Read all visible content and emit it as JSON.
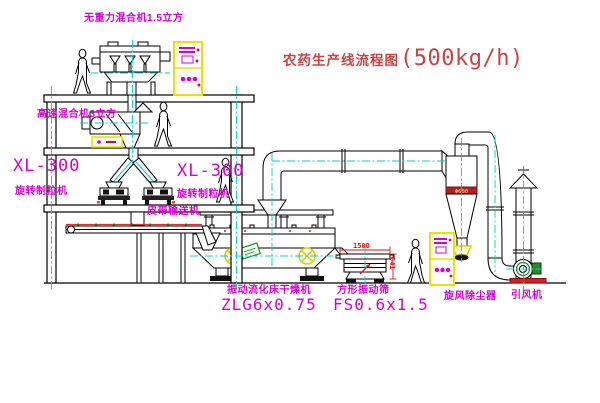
{
  "drawing": {
    "title_zh": "农药生产线流程图",
    "title_capacity": "(500kg/h)"
  },
  "equipment": {
    "gravity_mixer": "无重力混合机1.5立方",
    "high_speed_mixer": "高速混合机3立方",
    "granulator_left_model": "XL-300",
    "granulator_left_name": "旋转制粒机",
    "granulator_right_model": "XL-300",
    "granulator_right_name": "旋转制粒机",
    "belt_conveyor": "皮带输送机",
    "dryer_name": "振动流化床干燥机",
    "dryer_model": "ZLG6x0.75",
    "sieve_name": "方形振动筛",
    "sieve_model": "FS0.6x1.5",
    "cyclone": "旋风除尘器",
    "fan": "引风机"
  },
  "dimensions": {
    "sieve_width": "1500",
    "sieve_height": "541",
    "cyclone_band": "Φ600"
  },
  "colors": {
    "label_magenta": "#d400d4",
    "title_red": "#c64444",
    "dimension_red": "#e01010",
    "centerline_cyan": "#00cccc",
    "cabinet_yellow": "#f0e000",
    "line_black": "#000000"
  }
}
